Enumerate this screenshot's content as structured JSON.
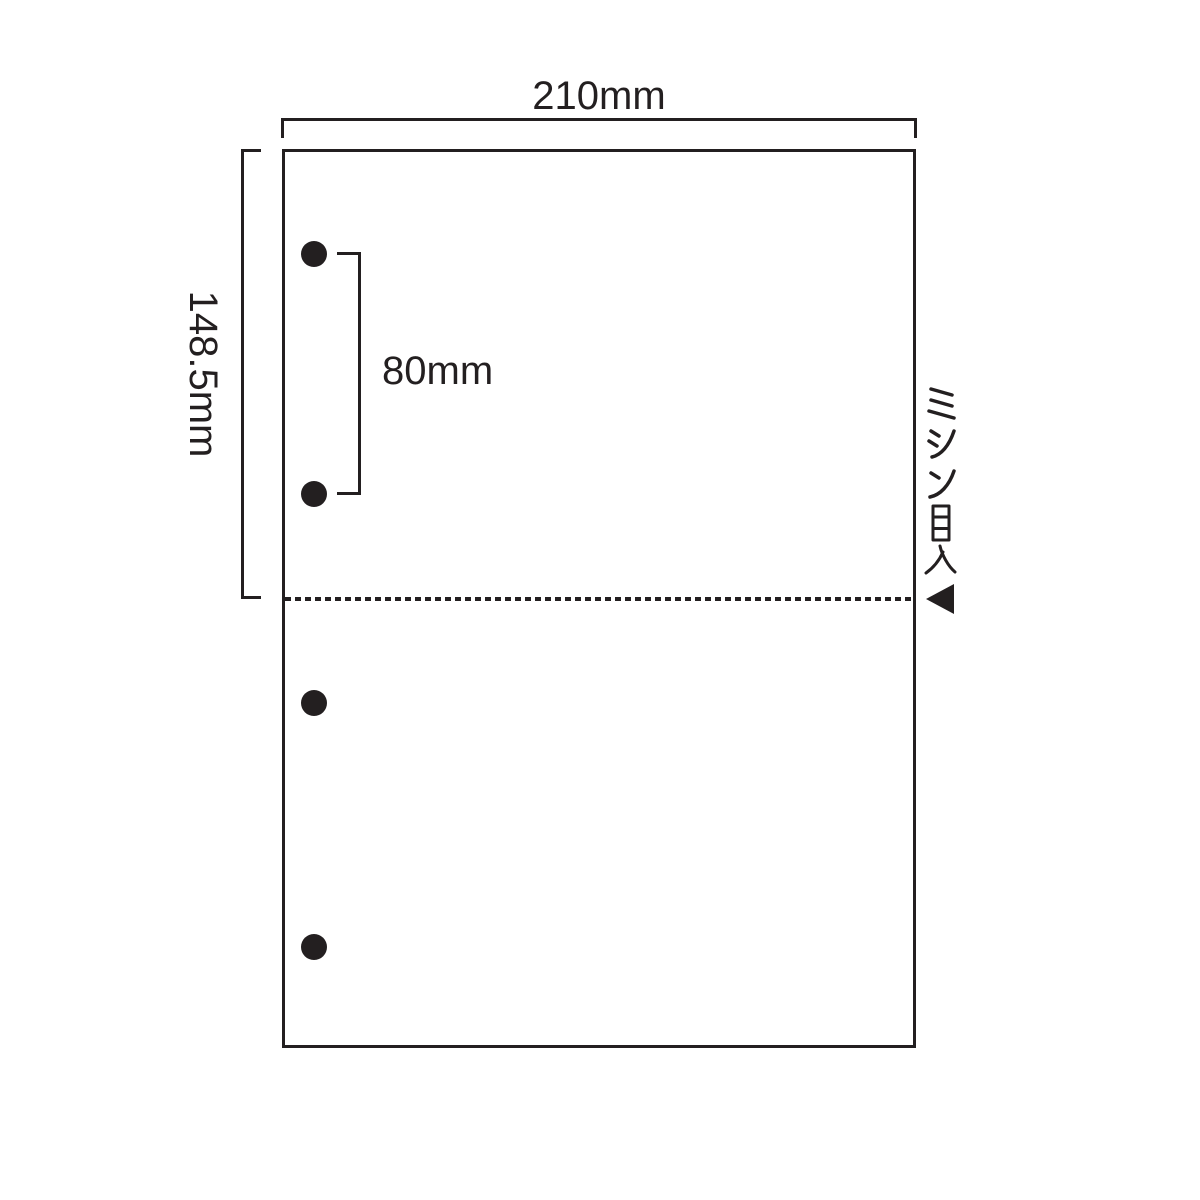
{
  "diagram": {
    "type": "paper-specification",
    "labels": {
      "width": "210mm",
      "half_height": "148.5mm",
      "hole_spacing": "80mm",
      "perforation": "ミシン目入"
    },
    "dimensions_mm": {
      "width": 210,
      "half_height": 148.5,
      "hole_spacing": 80
    },
    "holes": {
      "count": 4,
      "diameter_px": 26,
      "positions_px": [
        {
          "x": 314,
          "y": 254
        },
        {
          "x": 314,
          "y": 494
        },
        {
          "x": 314,
          "y": 703
        },
        {
          "x": 314,
          "y": 947
        }
      ]
    },
    "perforation_line": {
      "style": "dashed",
      "position": "half-height"
    },
    "icons": {
      "perforation_arrow": "left-pointing-triangle"
    },
    "colors": {
      "ink": "#231f20",
      "paper": "#ffffff"
    }
  }
}
